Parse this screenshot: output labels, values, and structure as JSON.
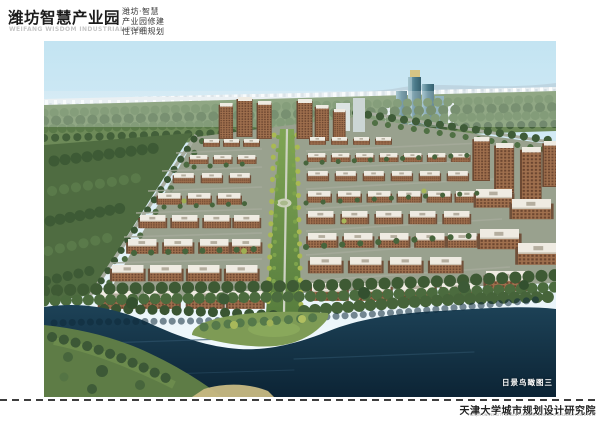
{
  "header": {
    "title": "潍坊智慧产业园",
    "title_en": "WEIFANG WISDOM INDUSTRIAL PARK",
    "project_lines": [
      "潍坊·智慧",
      "产业园修建",
      "性详细规划"
    ]
  },
  "rendering": {
    "caption": "日景鸟瞰图三",
    "description": "daytime aerial rendering of industrial park with central green axis, brown mid-rise buildings, glass towers and river"
  },
  "footer": {
    "institute": "天津大学城市规划设计研究院",
    "institute_en": "TIANJIN UNIVERSITY URBAN PLANNING DESIGN & RESEARCH INSTITUTE"
  },
  "colors": {
    "sky_top": "#c3e4f2",
    "water": "#14374c",
    "building_brown": "#9c6b4a",
    "roof_white": "#efebe2",
    "axis_green": "#6f9448",
    "forest_green": "#557244",
    "glass_tower": "#4e7d8d",
    "title_text": "#1c1c1c"
  }
}
